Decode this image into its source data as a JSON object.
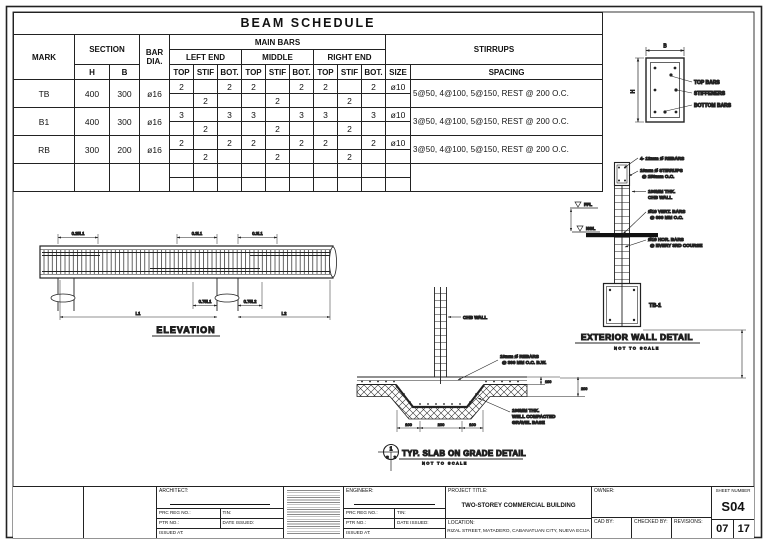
{
  "beam_schedule": {
    "title": "BEAM SCHEDULE",
    "headers": {
      "mark": "MARK",
      "section": "SECTION",
      "h": "H",
      "b": "B",
      "bar": "BAR",
      "dia": "DIA.",
      "main_bars": "MAIN BARS",
      "left_end": "LEFT END",
      "middle": "MIDDLE",
      "right_end": "RIGHT END",
      "top": "TOP",
      "stif": "STIF",
      "bot": "BOT.",
      "stirrups": "STIRRUPS",
      "size": "SIZE",
      "spacing": "SPACING"
    },
    "groups": [
      {
        "mark": "TB",
        "h": "400",
        "b": "300",
        "dia": "ø16",
        "size": "ø10",
        "spacing": "5@50, 4@100, 5@150, REST @ 200 O.C.",
        "r1": [
          "2",
          "",
          "2",
          "2",
          "",
          "2",
          "2",
          "",
          "2"
        ],
        "r2": [
          "",
          "2",
          "",
          "",
          "2",
          "",
          "",
          "2",
          ""
        ]
      },
      {
        "mark": "B1",
        "h": "400",
        "b": "300",
        "dia": "ø16",
        "size": "ø10",
        "spacing": "3@50, 4@100, 5@150, REST @ 200 O.C.",
        "r1": [
          "3",
          "",
          "3",
          "3",
          "",
          "3",
          "3",
          "",
          "3"
        ],
        "r2": [
          "",
          "2",
          "",
          "",
          "2",
          "",
          "",
          "2",
          ""
        ]
      },
      {
        "mark": "RB",
        "h": "300",
        "b": "200",
        "dia": "ø16",
        "size": "ø10",
        "spacing": "3@50, 4@100, 5@150, REST @ 200 O.C.",
        "r1": [
          "2",
          "",
          "2",
          "2",
          "",
          "2",
          "2",
          "",
          "2"
        ],
        "r2": [
          "",
          "2",
          "",
          "",
          "2",
          "",
          "",
          "2",
          ""
        ]
      },
      {
        "mark": "",
        "h": "",
        "b": "",
        "dia": "",
        "size": "",
        "spacing": "",
        "r1": [
          "",
          "",
          "",
          "",
          "",
          "",
          "",
          "",
          ""
        ],
        "r2": [
          "",
          "",
          "",
          "",
          "",
          "",
          "",
          "",
          ""
        ]
      }
    ]
  },
  "beam_section": {
    "dim_b": "B",
    "dim_h": "H",
    "labels": {
      "top": "TOP BARS",
      "stiffeners": "STIFFENERS",
      "bottom": "BOTTOM BARS"
    }
  },
  "elevation": {
    "title": "ELEVATION",
    "dims_top": [
      "0.25L1",
      "0.3L1",
      "0.3L1"
    ],
    "dims_bottom": [
      "0.75L1",
      "0.75L2"
    ],
    "dims_span": [
      "L1",
      "L2"
    ]
  },
  "wall_detail": {
    "title": "EXTERIOR WALL DETAIL",
    "subtitle": "NOT TO SCALE",
    "tag": "TB-1",
    "levels": {
      "ffl": "FFL",
      "ngl": "NGL"
    },
    "notes": [
      "4- 12mm Ø REBARS",
      "10mm Ø STIRRUPS",
      "@ 150mm O.C.",
      "100MM THK.",
      "CHB WALL",
      "Ø10 VERT. BARS",
      "@ 600 MM O.C.",
      "Ø10 HOR. BARS",
      "@ EVERY 3RD COURSE"
    ]
  },
  "slab_detail": {
    "title": "TYP. SLAB ON GRADE DETAIL",
    "subtitle": "NOT TO SCALE",
    "bubble": {
      "top": "1",
      "bottom_left": "S",
      "bottom_right": "2"
    },
    "notes": [
      "CHB WALL",
      "10mm Ø REBARS",
      "@ 300 MM O.C. B.W.",
      "100MM THK.",
      "WELL COMPACTED",
      "GRAVEL BASE"
    ],
    "dims_bottom": [
      "100",
      "200",
      "100"
    ],
    "dims_right": [
      "100",
      "200"
    ]
  },
  "title_block": {
    "architect_label": "ARCHITECT:",
    "engineer_label": "ENGINEER:",
    "prc_label": "PRC REG NO.:",
    "tin_label": "TIN:",
    "ptr_label": "PTR NO.:",
    "date_issued_label": "DATE ISSUED:",
    "issued_at_label": "ISSUED AT:",
    "project_title_label": "PROJECT TITLE:",
    "project_title": "TWO-STOREY COMMERCIAL BUILDING",
    "location_label": "LOCATION:",
    "location": "RIZAL STREET, MATADERO, CABANATUAN CITY, NUEVA ECIJA",
    "owner_label": "OWNER:",
    "cad_by_label": "CAD BY:",
    "checked_by_label": "CHECKED BY:",
    "revisions_label": "REVISIONS:",
    "sheet_number_label": "SHEET NUMBER",
    "sheet_number": "S04",
    "sheet_page": "07",
    "sheet_total": "17"
  }
}
